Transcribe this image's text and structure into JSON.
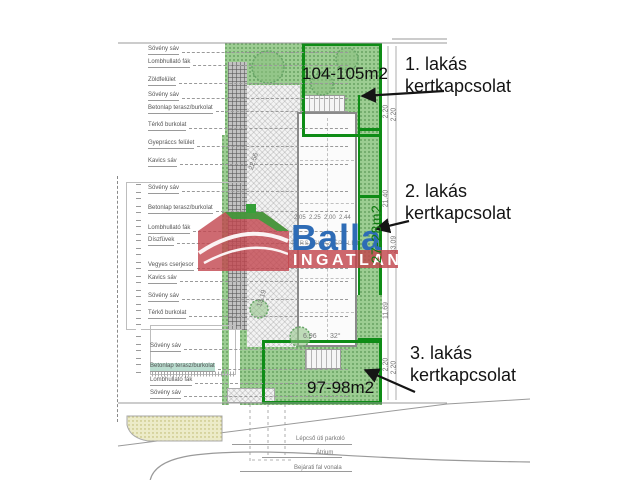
{
  "watermark": {
    "brand": "Balla",
    "subtitle": "INGATLAN",
    "brand_blue": "#2e6cb6",
    "brand_red": "#c2454d",
    "accent_green": "#35a038"
  },
  "areas": {
    "garden1": "104-105m2",
    "garden2": "27-28m2",
    "garden3": "97-98m2"
  },
  "callouts": [
    {
      "line1": "1. lakás",
      "line2": "kertkapcsolat"
    },
    {
      "line1": "2. lakás",
      "line2": "kertkapcsolat"
    },
    {
      "line1": "3. lakás",
      "line2": "kertkapcsolat"
    }
  ],
  "building_label": "TÁRSASHÁZ ÉPÜLET",
  "legend_top": [
    "Sövény sáv",
    "Lombhullató fák",
    "Zöldfelület",
    "Sövény sáv",
    "Betonlap terasz/burkolat",
    "Térkő burkolat",
    "Gyepráccs felület",
    "Kavics sáv"
  ],
  "legend_mid": [
    "Sövény sáv",
    "Betonlap terasz/burkolat",
    "Lombhullató fák",
    "Díszfüvek",
    "Vegyes cserjesor",
    "Kavics sáv",
    "Sövény sáv",
    "Térkő burkolat"
  ],
  "legend_bottom": [
    "Sövény sáv",
    "Betonlap terasz/burkolat",
    "Lombhullató fák",
    "Sövény sáv"
  ],
  "street_labels": [
    "Lépcső úti parkoló",
    "Átrium",
    "Bejárati fal vonala"
  ],
  "dims_right": [
    "2.20",
    "2.20",
    "21.40",
    "33.09",
    "11.69",
    "2.20",
    "2.20"
  ],
  "dims_plan": {
    "d1": "22.56",
    "d2": "13.19",
    "d3": "6.96",
    "d4": "32°",
    "row": "2.05  2.25  2.00  2.44"
  },
  "colors": {
    "garden_fill": "#9ccd92",
    "garden_border": "#0e8c16"
  }
}
